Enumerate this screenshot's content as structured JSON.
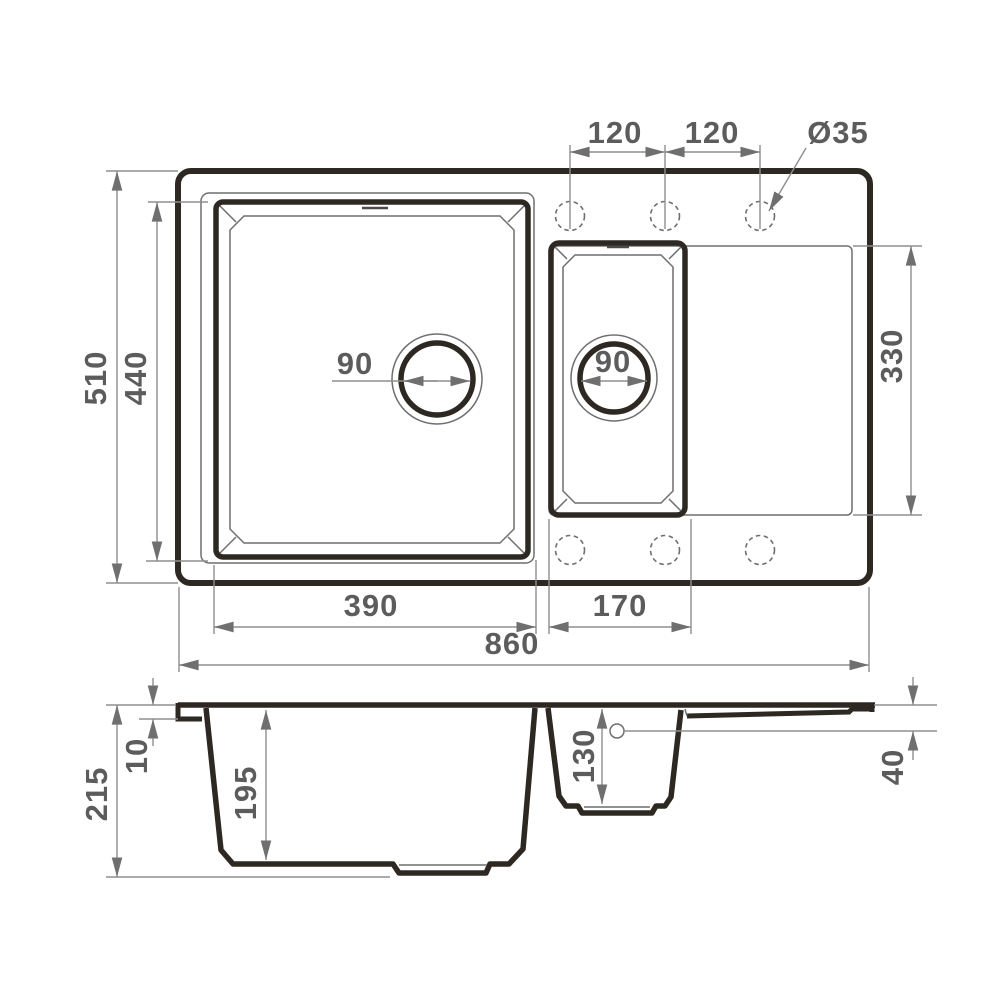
{
  "drawing_title": "sink-technical-drawing",
  "top_view": {
    "hole_spacing_left": "120",
    "hole_spacing_right": "120",
    "hole_diameter": "Ø35",
    "overall_depth": "510",
    "main_bowl_length": "440",
    "drainer_length": "330",
    "main_drain_diameter": "90",
    "half_drain_diameter": "90",
    "main_bowl_width": "390",
    "half_bowl_width": "170",
    "overall_width": "860"
  },
  "section_view": {
    "overall_height": "215",
    "rim_thickness": "10",
    "main_bowl_depth": "195",
    "half_bowl_depth": "130",
    "overflow_offset": "40"
  },
  "colors": {
    "line_dark": "#2e2823",
    "line_thin": "#6f6f6f",
    "dimension_gray": "#8f8f8f",
    "text_gray": "#5c5c5c",
    "background": "#ffffff"
  }
}
